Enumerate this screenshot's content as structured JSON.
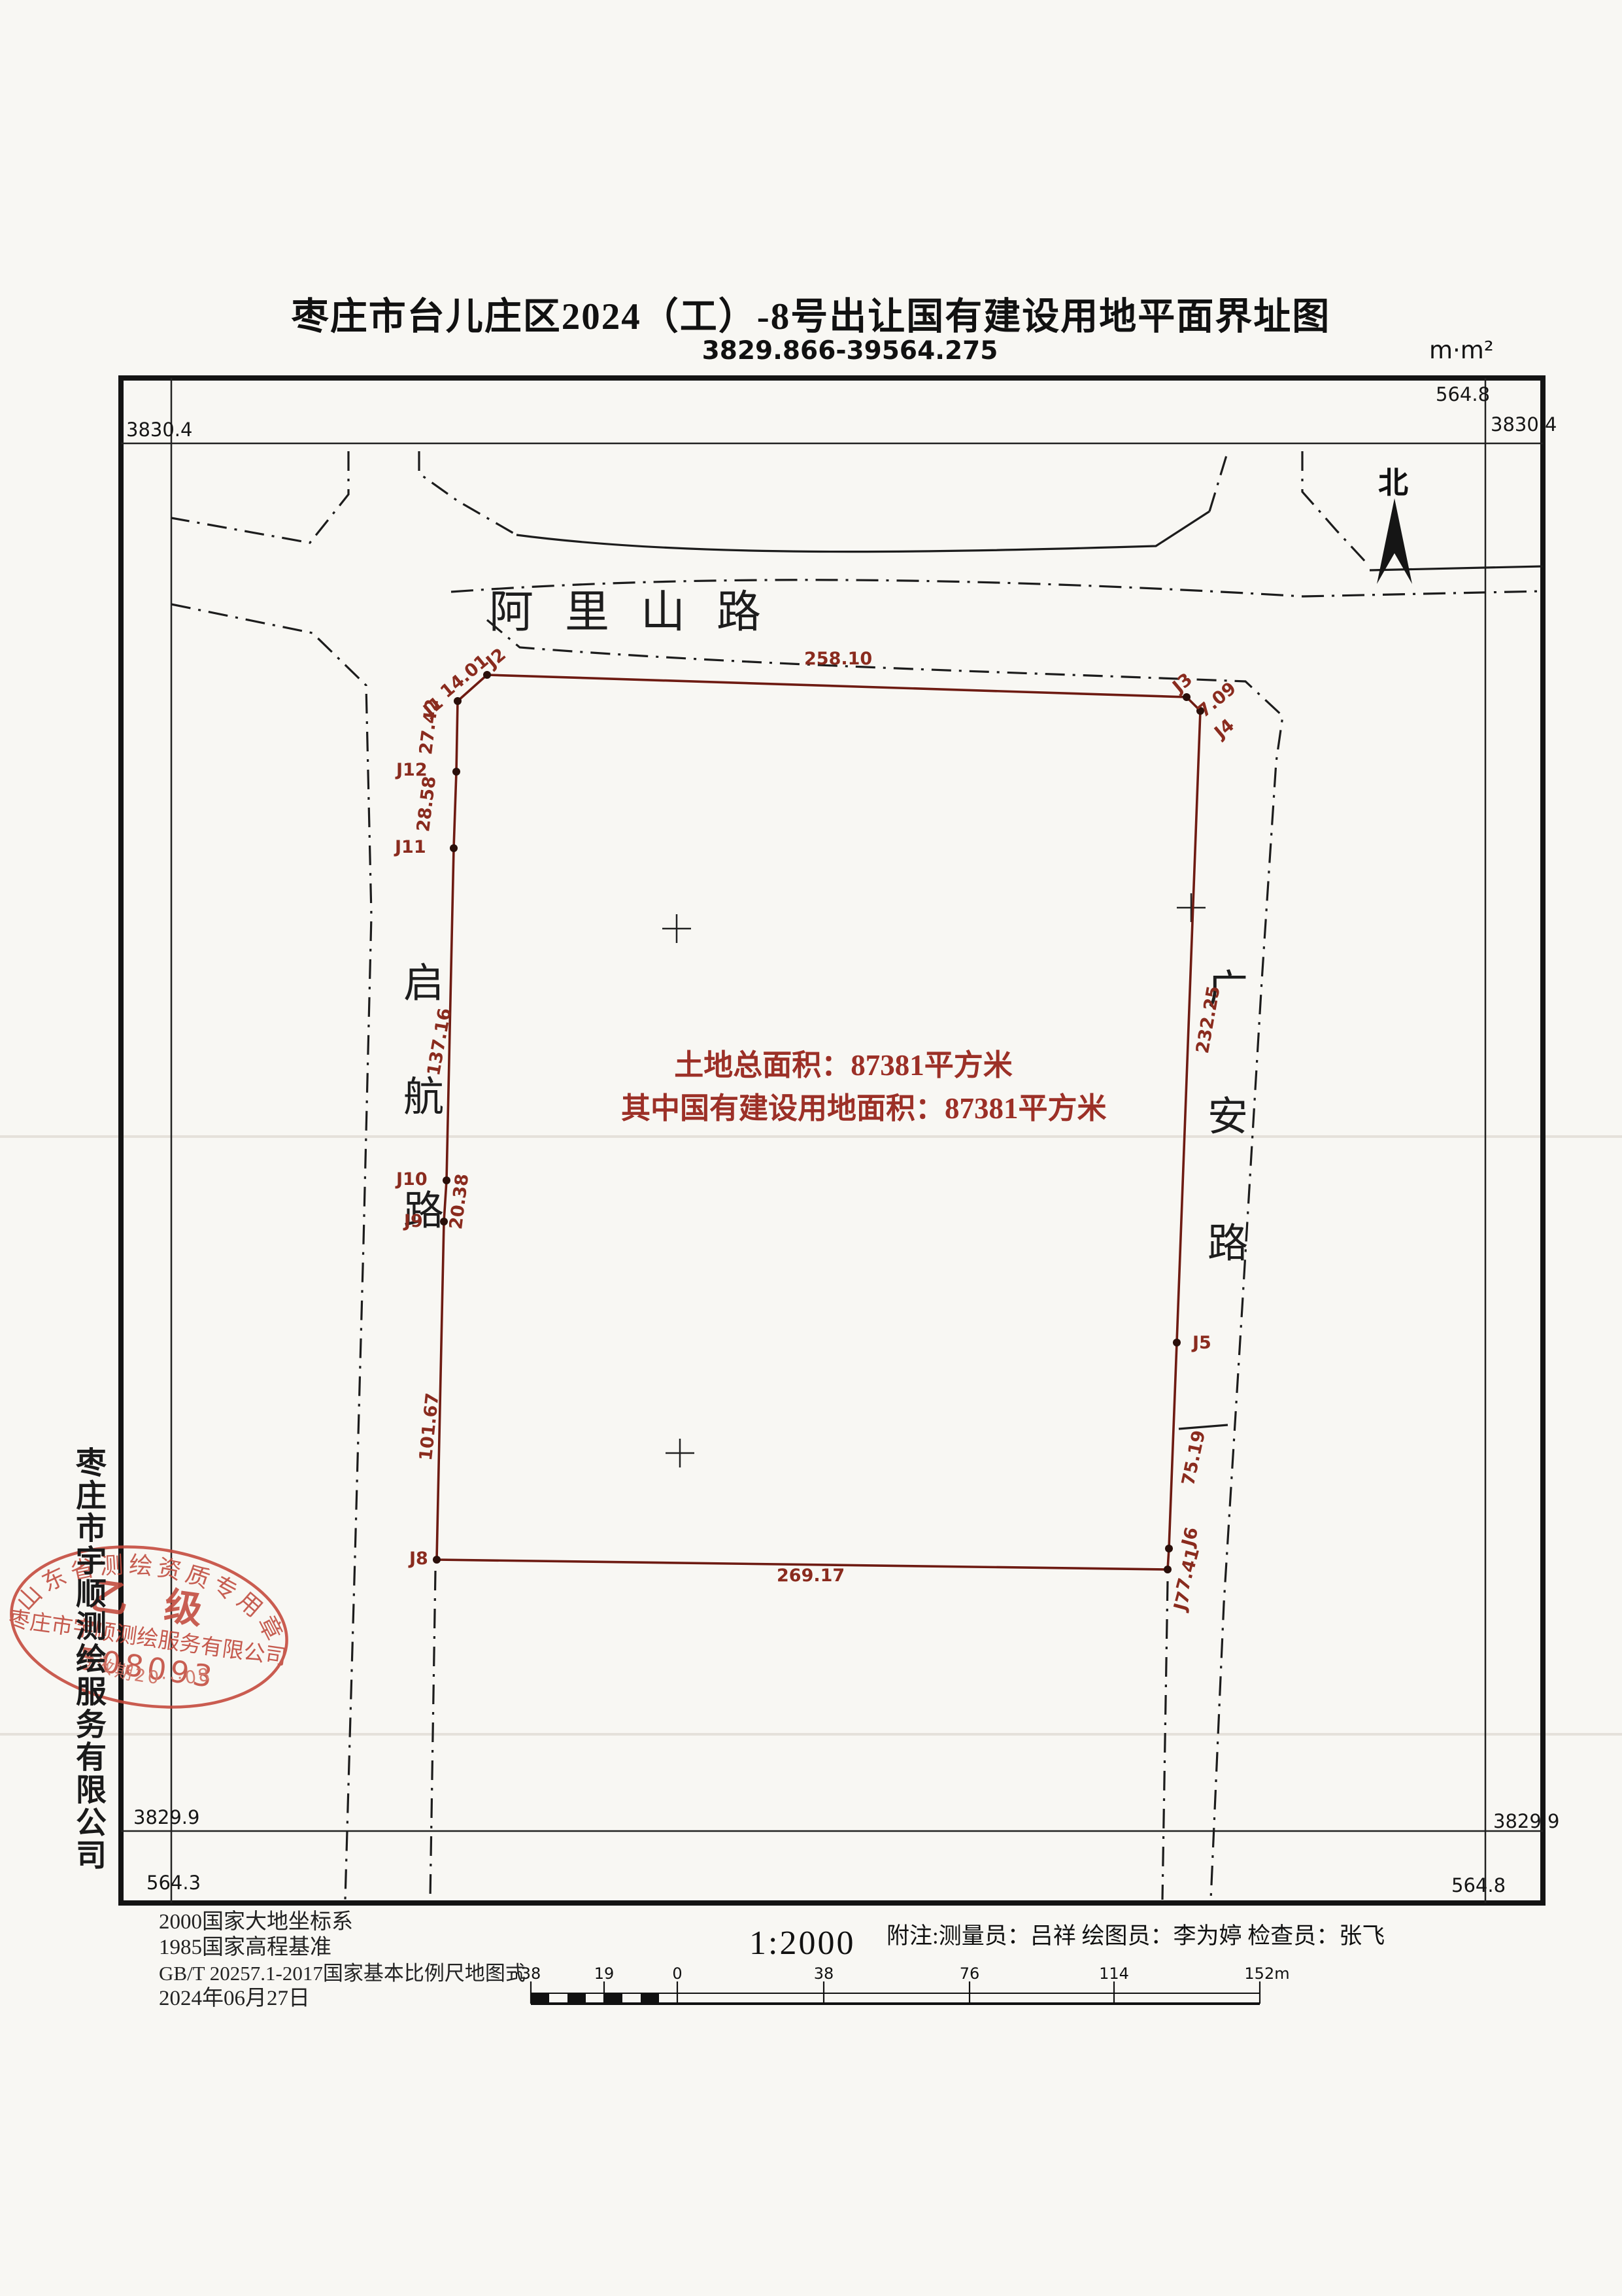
{
  "title": {
    "main": "枣庄市台儿庄区2024（工）-8号出让国有建设用地平面界址图",
    "subtitle": "3829.866-39564.275",
    "unit_note": "m·m²"
  },
  "compass": {
    "north_label": "北"
  },
  "grid_labels": {
    "top_left_n": "3830.4",
    "top_right_n": "3830.4",
    "top_right_e": "564.8",
    "bottom_left_n": "3829.9",
    "bottom_right_n": "3829.9",
    "bottom_left_e": "564.3",
    "bottom_right_e": "564.8"
  },
  "roads": {
    "top": "阿里山路",
    "left": "启航路",
    "right": "广安路"
  },
  "parcel": {
    "area_line1": "土地总面积：87381平方米",
    "area_line2": "其中国有建设用地面积：87381平方米",
    "points": {
      "J1": "J1",
      "J2": "J2",
      "J3": "J3",
      "J4": "J4",
      "J5": "J5",
      "J6": "J6",
      "J7": "J7",
      "J8": "J8",
      "J9": "J9",
      "J10": "J10",
      "J11": "J11",
      "J12": "J12"
    },
    "lengths": {
      "J1_J2": "14.01",
      "J2_J3": "258.10",
      "J3_J4": "7.09",
      "J4_J5": "232.25",
      "J5_J6": "75.19",
      "J6_J7": "7.41",
      "J7_J8": "269.17",
      "J8_J9": "101.67",
      "J9_J10": "20.38",
      "J10_J11": "137.16",
      "J11_J12": "28.58",
      "J12_J1": "27.42"
    }
  },
  "stamp": {
    "top_arc": "山东省测绘资质专用章",
    "grade": "乙 级",
    "band": "枣庄市宇顺测绘服务有限公司",
    "number": "508093",
    "bottom_arc": "有效期20···08"
  },
  "side_company": "枣庄市宇顺测绘服务有限公司",
  "footer": {
    "datum_lines": [
      "2000国家大地坐标系",
      "1985国家高程基准",
      "GB/T 20257.1-2017国家基本比例尺地图式",
      "2024年06月27日"
    ],
    "scale_text": "1:2000",
    "notes": "附注:测量员：吕祥 绘图员：李为婷 检查员：张飞",
    "scale_bar": {
      "unit": "m",
      "labels": [
        "38",
        "19",
        "0",
        "38",
        "76",
        "114",
        "152m"
      ]
    }
  }
}
